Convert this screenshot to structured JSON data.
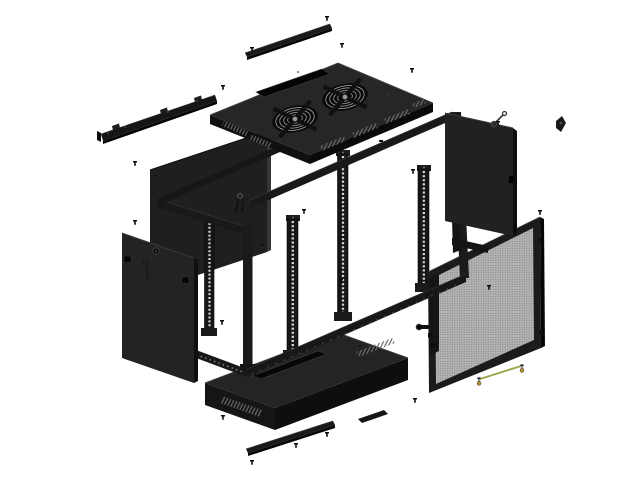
{
  "figure": {
    "subject": "Exploded view of a wall-mount 19-inch network server rack cabinet",
    "view": "isometric exploded 3D render",
    "background_color": "#ffffff"
  },
  "colors": {
    "panel_body": "#232323",
    "panel_dark_edge": "#0d0d0d",
    "panel_highlight": "#3a3a3a",
    "frame_steel": "#191919",
    "mesh_base": "#b5b5b5",
    "mesh_dot": "#858585",
    "rail_hole_light": "#d8d8d8",
    "ground_wire_green": "#9aa645",
    "terminal_brass": "#b5913c",
    "background": "#ffffff"
  },
  "parts": [
    {
      "id": "wall-mount-bracket",
      "name": "Wall-mount bracket strip with keyhole tabs"
    },
    {
      "id": "top-cover-strip",
      "name": "Top cable-entry cover strip"
    },
    {
      "id": "top-panel",
      "name": "Top panel with dual fan grilles and cable slot"
    },
    {
      "id": "fan-grille-left",
      "name": "Left cooling fan grille"
    },
    {
      "id": "fan-grille-right",
      "name": "Right cooling fan grille"
    },
    {
      "id": "back-panel",
      "name": "Rear wall panel"
    },
    {
      "id": "accessory-keys",
      "name": "Spare keys on ring"
    },
    {
      "id": "cabinet-frame",
      "name": "Welded cabinet frame skeleton"
    },
    {
      "id": "rack-rail-1",
      "name": "19-inch mounting rail (rear left)"
    },
    {
      "id": "rack-rail-2",
      "name": "19-inch mounting rail (front left)"
    },
    {
      "id": "rack-rail-3",
      "name": "19-inch mounting rail (rear right)"
    },
    {
      "id": "rack-rail-4",
      "name": "19-inch mounting rail (front right)"
    },
    {
      "id": "left-side-panel",
      "name": "Left side panel with cam lock"
    },
    {
      "id": "left-panel-key",
      "name": "Key hanging from left panel lock"
    },
    {
      "id": "right-side-panel",
      "name": "Right side panel with cam lock"
    },
    {
      "id": "right-panel-latch",
      "name": "Right panel latch bracket"
    },
    {
      "id": "side-frame",
      "name": "Side panel mounting frame"
    },
    {
      "id": "mesh-front-door",
      "name": "Perforated mesh front door with lock"
    },
    {
      "id": "bottom-tray",
      "name": "Bottom panel with cable slot and vents"
    },
    {
      "id": "bottom-cover-strip",
      "name": "Bottom cable-entry cover strip"
    },
    {
      "id": "grounding-wire",
      "name": "Grounding wire with screw terminals"
    },
    {
      "id": "screws",
      "name": "Mounting screws",
      "count": 19
    }
  ]
}
